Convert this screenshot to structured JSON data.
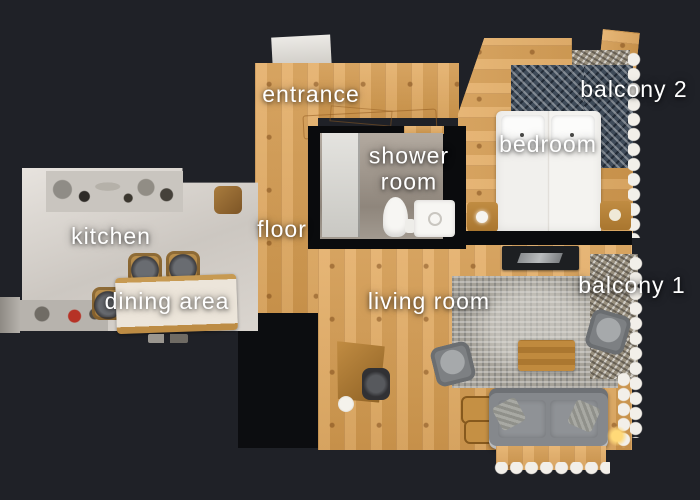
{
  "scene": {
    "type": "apartment floor plan, top-down 3D scan",
    "background_color": "#1f2127",
    "wall_color": "#0a0b0d",
    "label_color": "#ffffff"
  },
  "labels": {
    "entrance": "entrance",
    "shower_room": "shower room",
    "bedroom": "bedroom",
    "balcony2": "balcony 2",
    "kitchen": "kitchen",
    "floor": "floor",
    "dining_area": "dining area",
    "living_room": "living room",
    "balcony1": "balcony 1"
  },
  "palette": {
    "wood_floor": "#d9a159",
    "kitchen_floor": "#d8d3cd",
    "bedroom_rug": "#3f4b59",
    "living_rug": "#a5a198",
    "sofa": "#85888c",
    "bed": "#f3f2ef",
    "snow_edge": "#f2efe9"
  }
}
